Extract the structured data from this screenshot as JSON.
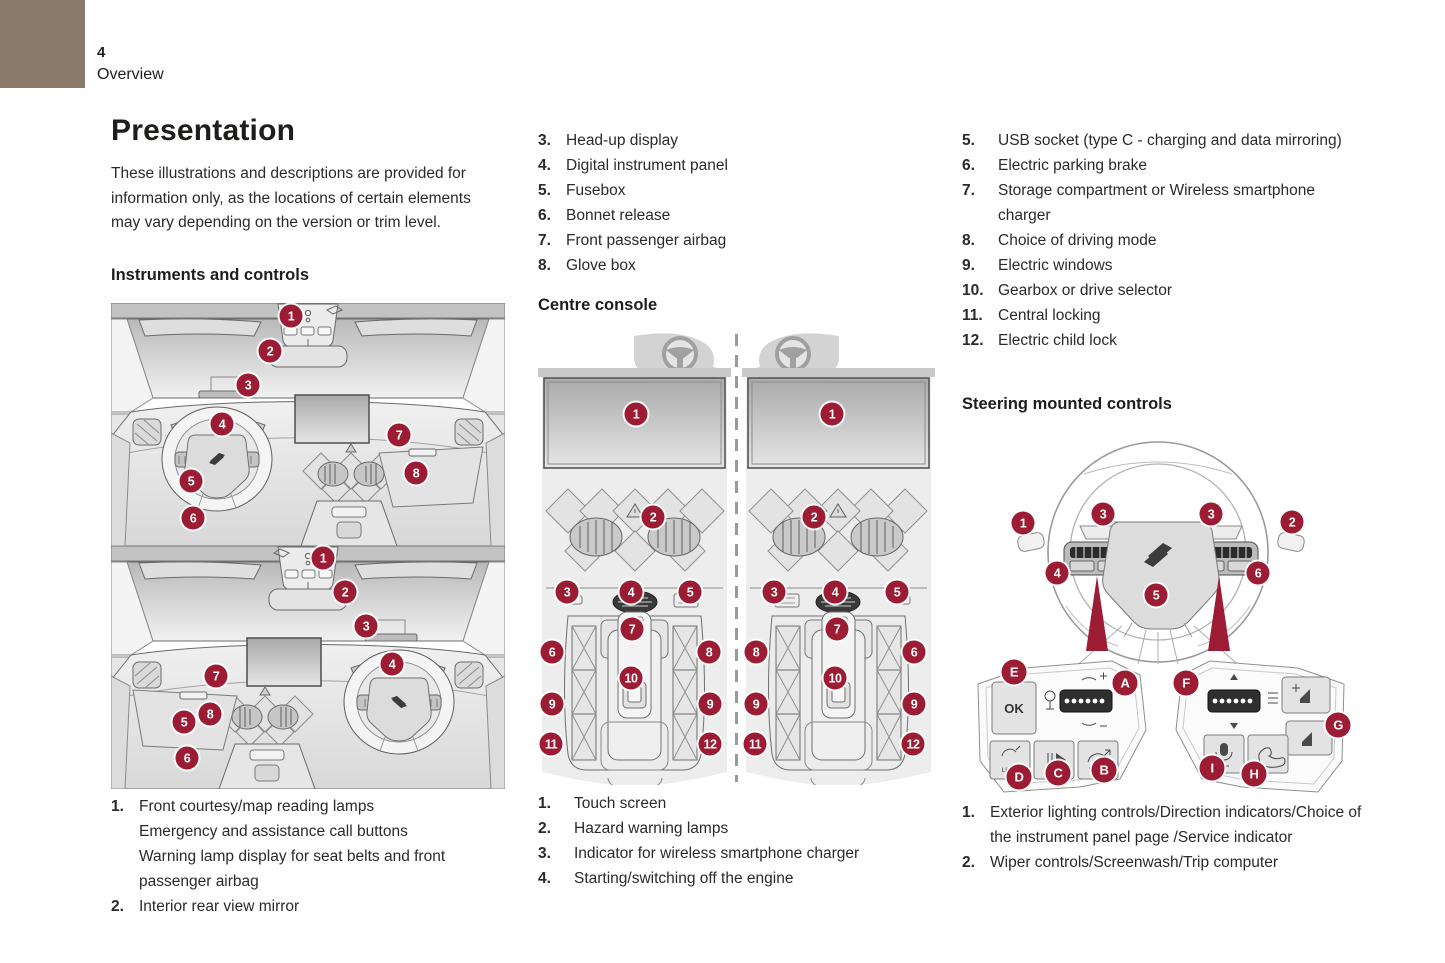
{
  "page": {
    "number": "4",
    "section": "Overview"
  },
  "colors": {
    "badge": "#9b1c33",
    "corner_tab": "#8a7a6a"
  },
  "title": "Presentation",
  "intro": "These illustrations and descriptions are provided for information only, as the locations of certain elements may vary depending on the version or trim level.",
  "left": {
    "heading": "Instruments and controls",
    "list": [
      {
        "num": "1.",
        "lines": [
          "Front courtesy/map reading lamps",
          "Emergency and assistance call buttons",
          "Warning lamp display for seat belts and front passenger airbag"
        ]
      },
      {
        "num": "2.",
        "lines": [
          "Interior rear view mirror"
        ]
      }
    ]
  },
  "middle": {
    "list_top": [
      {
        "num": "3.",
        "text": "Head-up display"
      },
      {
        "num": "4.",
        "text": "Digital instrument panel"
      },
      {
        "num": "5.",
        "text": "Fusebox"
      },
      {
        "num": "6.",
        "text": "Bonnet release"
      },
      {
        "num": "7.",
        "text": "Front passenger airbag"
      },
      {
        "num": "8.",
        "text": "Glove box"
      }
    ],
    "heading": "Centre console",
    "list_bottom": [
      {
        "num": "1.",
        "text": "Touch screen"
      },
      {
        "num": "2.",
        "text": "Hazard warning lamps"
      },
      {
        "num": "3.",
        "text": "Indicator for wireless smartphone charger"
      },
      {
        "num": "4.",
        "text": "Starting/switching off the engine"
      }
    ]
  },
  "right": {
    "list_top": [
      {
        "num": "5.",
        "text": "USB socket (type C - charging and data mirroring)"
      },
      {
        "num": "6.",
        "text": "Electric parking brake"
      },
      {
        "num": "7.",
        "text": "Storage compartment or Wireless smartphone charger"
      },
      {
        "num": "8.",
        "text": "Choice of driving mode"
      },
      {
        "num": "9.",
        "text": "Electric windows"
      },
      {
        "num": "10.",
        "text": "Gearbox or drive selector"
      },
      {
        "num": "11.",
        "text": "Central locking"
      },
      {
        "num": "12.",
        "text": "Electric child lock"
      }
    ],
    "heading": "Steering mounted controls",
    "list_bottom": [
      {
        "num": "1.",
        "text": "Exterior lighting controls/Direction indicators/Choice of the instrument panel page /Service indicator"
      },
      {
        "num": "2.",
        "text": "Wiper controls/Screenwash/Trip computer"
      }
    ]
  },
  "diagrams": {
    "dash": {
      "callouts": [
        "1",
        "2",
        "3",
        "4",
        "5",
        "6",
        "7",
        "8"
      ]
    },
    "console": {
      "callouts": [
        "1",
        "2",
        "3",
        "4",
        "5",
        "6",
        "7",
        "8",
        "9",
        "10",
        "11",
        "12"
      ]
    },
    "wheel": {
      "numbers": [
        "1",
        "2",
        "3",
        "4",
        "5",
        "6"
      ],
      "letters": [
        "A",
        "B",
        "C",
        "D",
        "E",
        "F",
        "G",
        "H",
        "I"
      ],
      "ok_label": "OK",
      "limit_label": "LIMIT"
    }
  }
}
